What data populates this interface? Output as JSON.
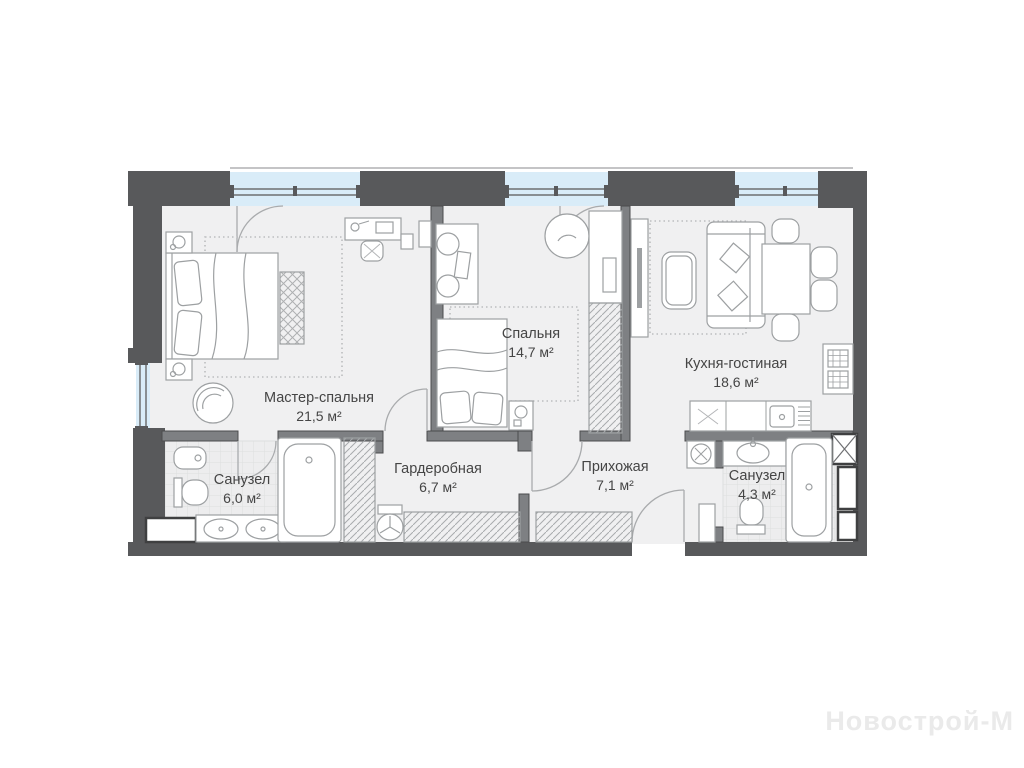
{
  "plan": {
    "rooms": [
      {
        "name": "Мастер-спальня",
        "area": "21,5 м²"
      },
      {
        "name": "Спальня",
        "area": "14,7 м²"
      },
      {
        "name": "Кухня-гостиная",
        "area": "18,6 м²"
      },
      {
        "name": "Санузел",
        "area": "6,0 м²"
      },
      {
        "name": "Гардеробная",
        "area": "6,7 м²"
      },
      {
        "name": "Прихожая",
        "area": "7,1 м²"
      },
      {
        "name": "Санузел",
        "area": "4,3 м²"
      }
    ],
    "watermark": "Новострой-М",
    "colors": {
      "wall": "#58595b",
      "interior_wall": "#7e8083",
      "glass": "#d9ecf8",
      "floor": "#f0f0f1",
      "tile": "#ededee",
      "furniture_stroke": "#9da0a2",
      "label_text": "#454545",
      "watermark": "#eaeaea"
    }
  }
}
